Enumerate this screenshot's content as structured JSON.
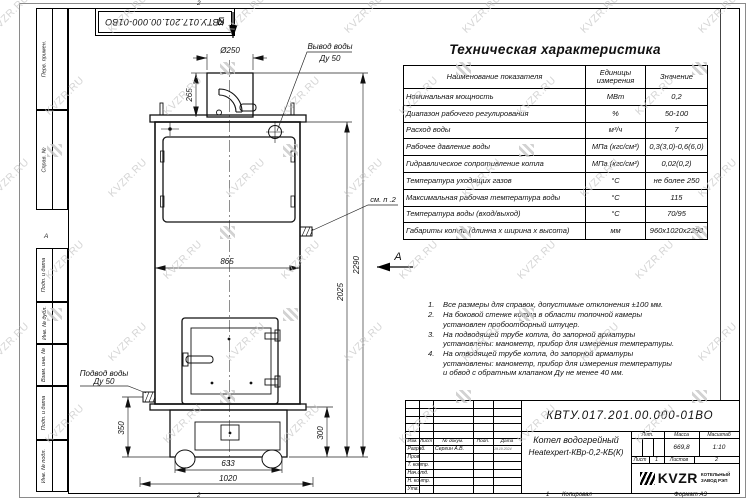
{
  "sheet": {
    "corner_doc_number": "КВТУ.017.201.00.000-01ВО",
    "zone_top": "2",
    "zone_bottom": "2",
    "fold_mark": "А",
    "copy_num": "1",
    "copied": "Копировал",
    "format": "Формат А3"
  },
  "margins": {
    "items": [
      "Перв. примен.",
      "Справ. №",
      "Подп. и дата",
      "Инв. № дубл.",
      "Взам. инв. №",
      "Подп. и дата",
      "Инв. № подл."
    ]
  },
  "watermark": {
    "text": "KVZR.RU"
  },
  "tech_table": {
    "title": "Техническая характеристика",
    "headers": [
      "Наименование показателя",
      "Единицы измерения",
      "Значение"
    ],
    "rows": [
      [
        "Номинальная мощность",
        "МВт",
        "0,2"
      ],
      [
        "Диапазон рабочего регулирования",
        "%",
        "50-100"
      ],
      [
        "Расход воды",
        "м³/ч",
        "7"
      ],
      [
        "Рабочее давление воды",
        "МПа (кгс/см²)",
        "0,3(3,0)-0,6(6,0)"
      ],
      [
        "Гидравлическое сопротивление котла",
        "МПа (кгс/см²)",
        "0,02(0,2)"
      ],
      [
        "Температура уходящих газов",
        "°С",
        "не более 250"
      ],
      [
        "Максимальная рабочая температура воды",
        "°С",
        "115"
      ],
      [
        "Температура воды (вход/выход)",
        "°С",
        "70/95"
      ],
      [
        "Габариты котла (длинна x ширина x высота)",
        "мм",
        "960x1020x2290"
      ]
    ]
  },
  "notes": [
    "Все размеры для справок, допустимые отклонения ±100 мм.",
    "На боковой стенке котла в области топочной камеры установлен пробоотборный штуцер.",
    "На подводящей трубе котла, до запорной арматуры установлены: манометр, прибор для измерения температуры.",
    "На отводящей трубе котла, до запорной арматуры установлены: манометр, прибор для измерения температуры и обвод с обратным клапаном Ду не менее 40 мм."
  ],
  "drawing": {
    "view_b": "Б",
    "view_a": "А",
    "outlet_line1": "Вывод воды",
    "outlet_line2": "Ду 50",
    "inlet_line1": "Подвод воды",
    "inlet_line2": "Ду 50",
    "see_note": "см. п .2",
    "dims": {
      "chimney_d": "Ø250",
      "chimney_h": "265",
      "body_w": "865",
      "h_body": "2025",
      "h_total": "2290",
      "base_h_left": "350",
      "base_h_right": "300",
      "base_w_inner": "633",
      "base_w_outer": "1020"
    }
  },
  "title_block": {
    "doc_number": "КВТУ.017.201.00.000-01ВО",
    "name_line1": "Котел водогрейный",
    "name_line2": "Heatexpert-КВр-0,2-КБ(К)",
    "header_cols": [
      "Изм.",
      "Лист",
      "№ докум.",
      "Подп.",
      "Дата"
    ],
    "rows": [
      {
        "label": "Разраб.",
        "name": "Сергин А.В.",
        "date": "19.10.2024"
      },
      {
        "label": "Пров.",
        "name": "",
        "date": ""
      },
      {
        "label": "Т. контр.",
        "name": "",
        "date": ""
      },
      {
        "label": "Нач.отд.",
        "name": "",
        "date": ""
      },
      {
        "label": "Н. контр.",
        "name": "",
        "date": ""
      },
      {
        "label": "Утв.",
        "name": "",
        "date": ""
      }
    ],
    "lit_label": "Лит.",
    "mass_label": "Масса",
    "scale_label": "Масштаб",
    "mass_value": "669,8",
    "scale_value": "1:10",
    "sheet_label": "Лист",
    "sheet_value": "1",
    "sheets_label": "Листов",
    "sheets_value": "2",
    "logo_text": "KVZR",
    "company_line1": "КОТЕЛЬНЫЙ",
    "company_line2": "ЗАВОД РЭП"
  }
}
